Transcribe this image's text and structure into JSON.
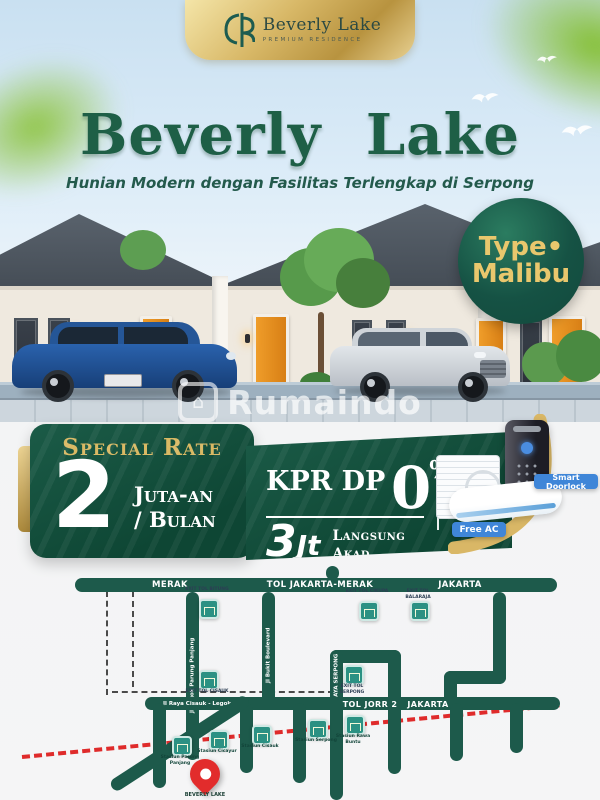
{
  "brand": {
    "name": "Beverly Lake",
    "tagline": "PREMIUM RESIDENCE"
  },
  "hero": {
    "title": "Beverly Lake",
    "subtitle": "Hunian Modern dengan Fasilitas Terlengkap di Serpong"
  },
  "type_badge": {
    "line1": "Type•",
    "line2": "Malibu"
  },
  "watermark": {
    "text": "Rumaindo",
    "house_glyph": "⌂"
  },
  "offer": {
    "special_rate_label": "Special Rate",
    "rate_number": "2",
    "rate_unit_line1": "Juta-an",
    "rate_unit_line2": "/ Bulan",
    "kpr_label": "KPR DP",
    "kpr_zero": "0",
    "kpr_percent": "%",
    "booking_number": "3",
    "booking_suffix": "Jt",
    "booking_note_line1": "Langsung",
    "booking_note_line2": "Akad",
    "doorlock_label": "Smart Doorlock",
    "ac_label": "Free AC"
  },
  "map": {
    "top_road": {
      "left": "MERAK",
      "center": "TOL JAKARTA-MERAK",
      "right": "JAKARTA"
    },
    "mid_road": {
      "street": "Jl Raya Cisauk - Legok",
      "toll": "TOL JORR 2",
      "right": "JAKARTA"
    },
    "streets": {
      "v1": "Jl Legok Parung Panjang",
      "v2": "Jl Bukit Boulevard",
      "v3": "Jl RAYA SERPONG"
    },
    "exits": [
      "EXIT TOL BITUNG",
      "EXIT TOL CIKUPA",
      "EXIT TOL BALARAJA",
      "EXIT TOL CISAUK",
      "EXIT TOL SERPONG"
    ],
    "stations": [
      "Stasiun Parung Panjang",
      "Stasiun Cicayur",
      "Stasiun Cisauk",
      "Stasiun Serpong",
      "Stasiun Rawa Buntu"
    ],
    "pin_label": "BEVERLY LAKE"
  },
  "colors": {
    "brand_green": "#14523f",
    "road_green": "#1d5a4b",
    "gold": "#d7b667",
    "rail_red": "#df2b2b",
    "label_blue": "#3f86d8",
    "door_orange": "#e0891c"
  }
}
